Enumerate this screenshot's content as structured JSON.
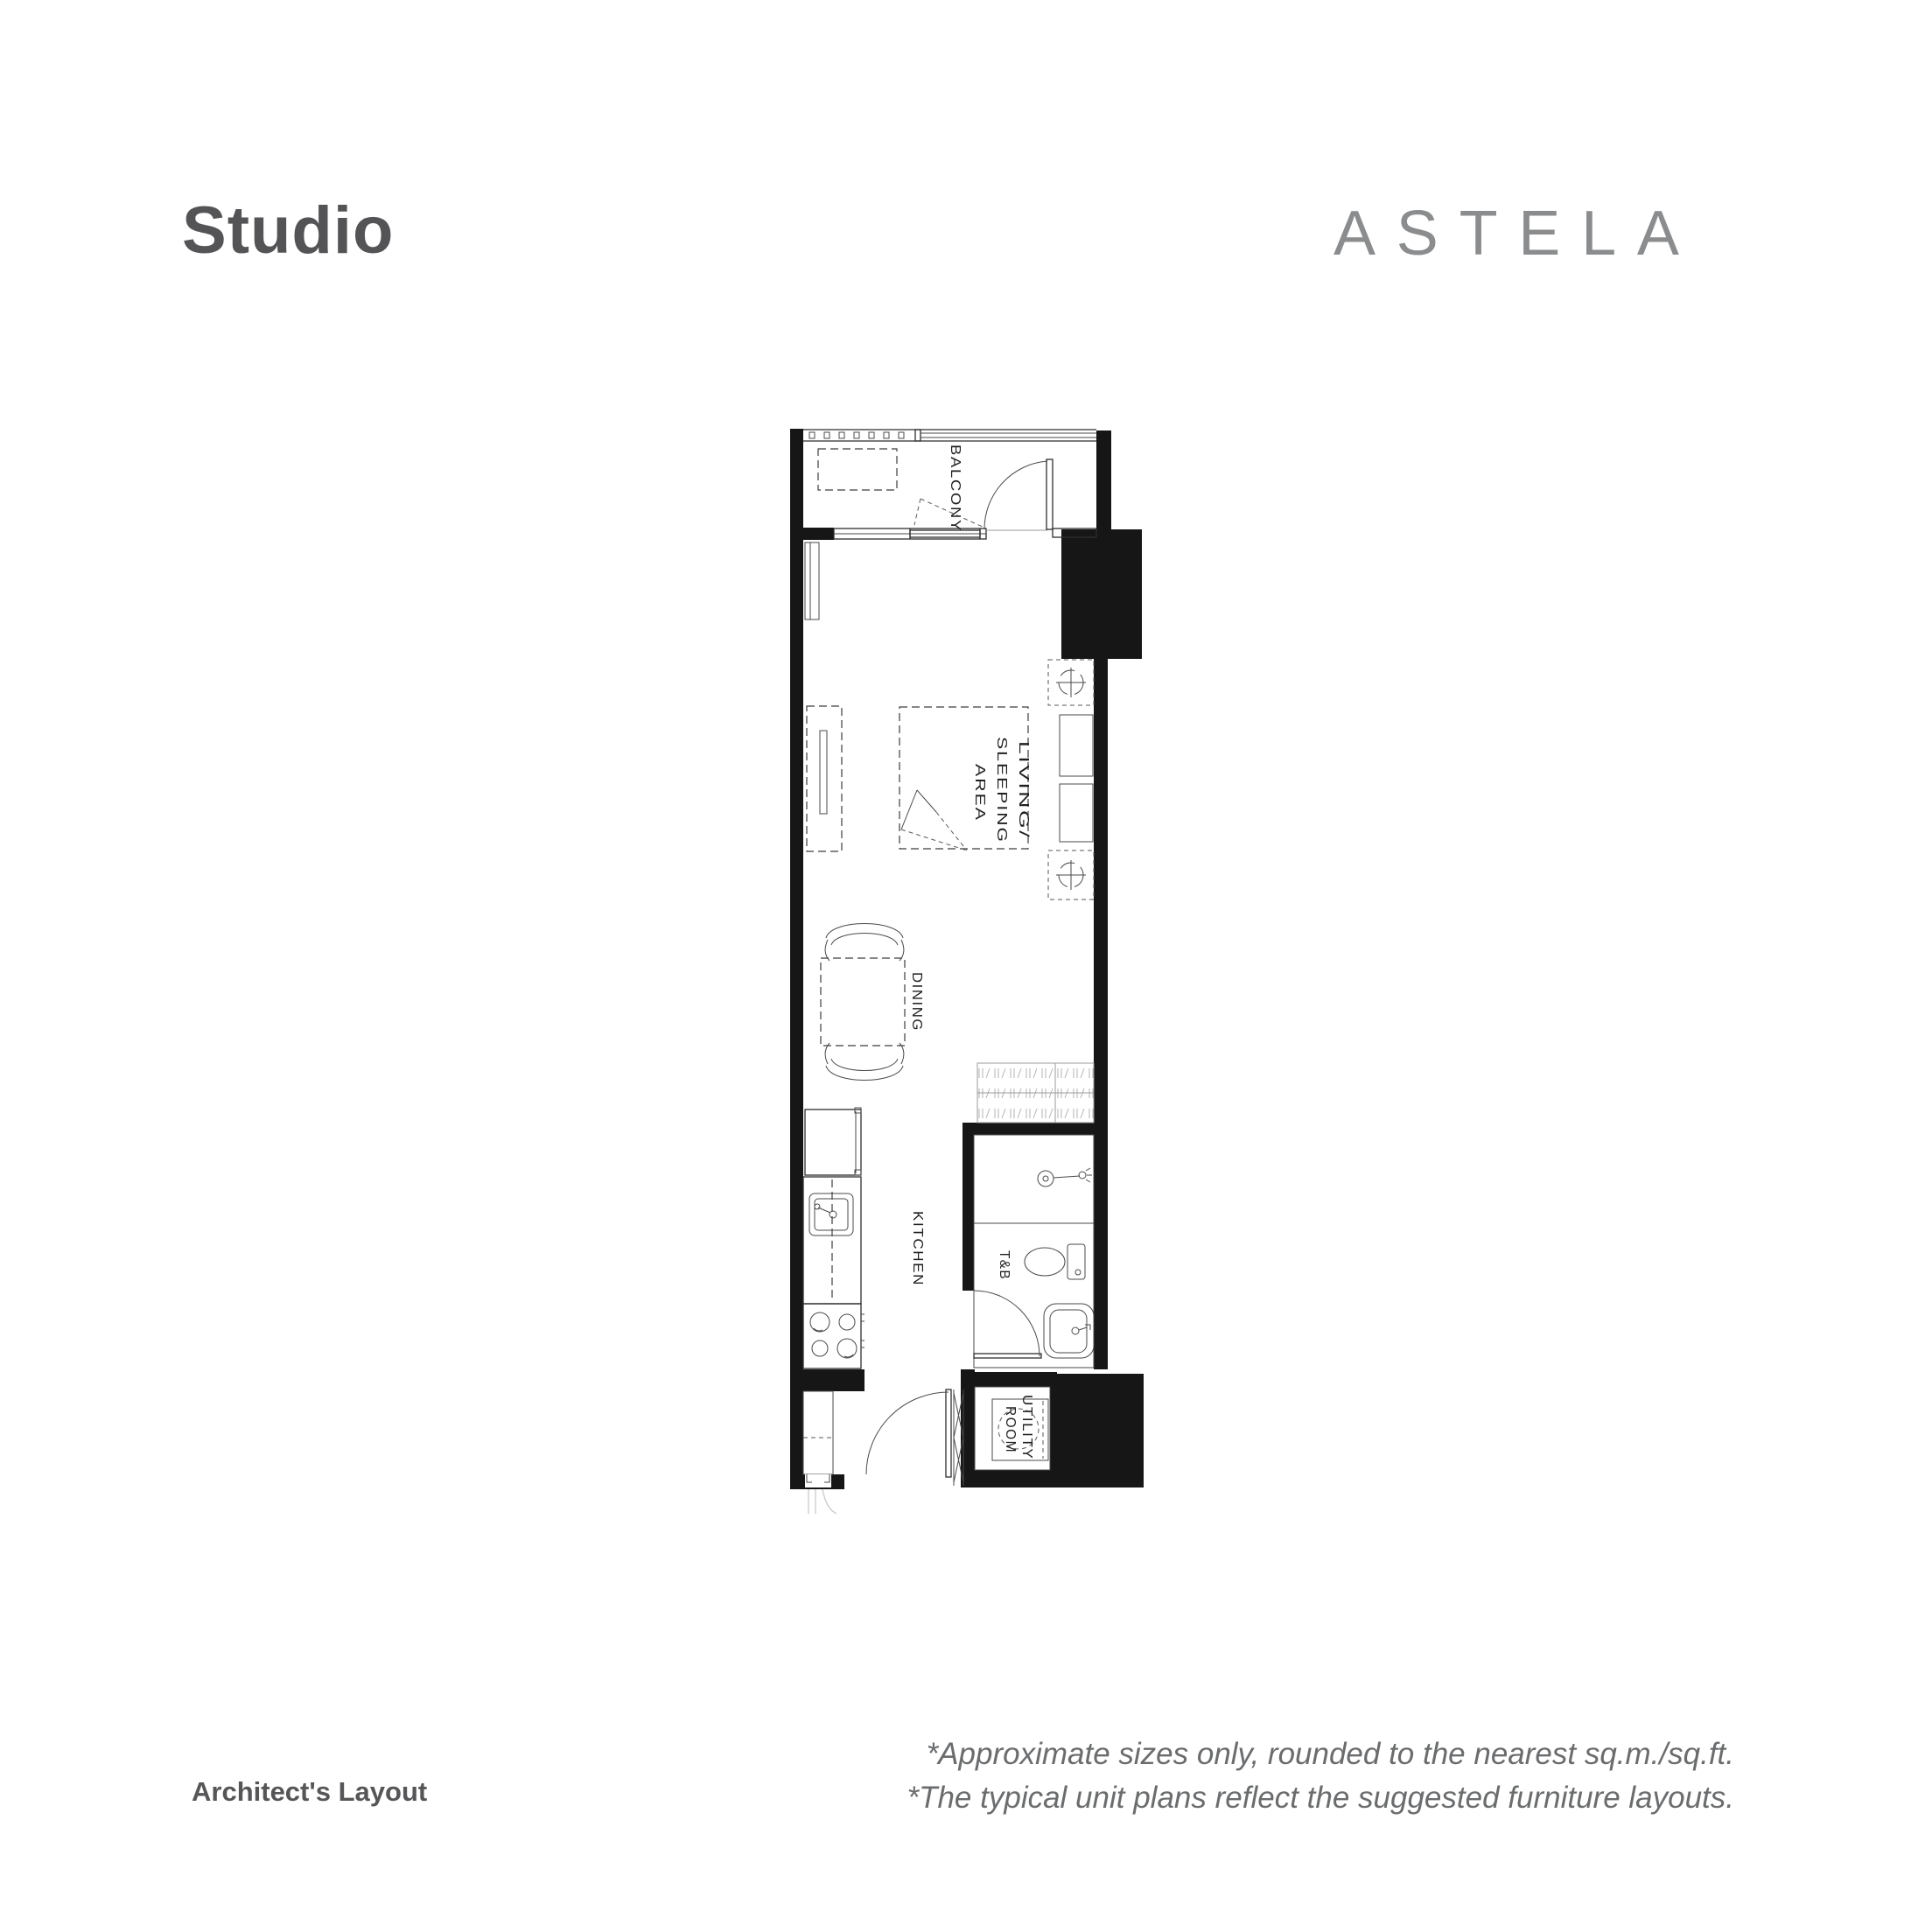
{
  "page": {
    "title": "Studio",
    "brand": "ASTELA"
  },
  "plan": {
    "rooms": {
      "balcony": "BALCONY",
      "living_sleeping": [
        "LIVING/",
        "SLEEPING",
        "AREA"
      ],
      "dining": "DINING",
      "kitchen": "KITCHEN",
      "toilet_bath": "T&B",
      "utility": [
        "UTILITY",
        "ROOM"
      ]
    }
  },
  "footnotes": {
    "line1": "*Approximate sizes only, rounded to the nearest sq.m./sq.ft.",
    "line2": "*The typical unit plans reflect the suggested furniture layouts."
  },
  "footer_label": "Architect's Layout",
  "colors": {
    "title": "#545456",
    "brand": "#8a8c8e",
    "notes": "#6a6c6e",
    "plan_line": "#2d2d2d"
  }
}
